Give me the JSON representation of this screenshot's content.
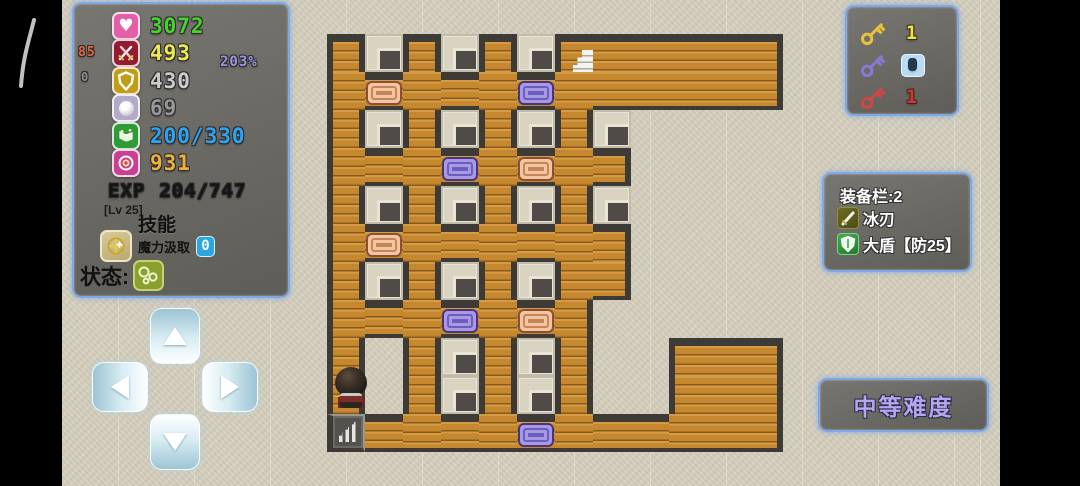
{
  "hud": {
    "stats": [
      {
        "name": "hp",
        "icon": "heart-icon",
        "value": "3072",
        "color": "#46d42a",
        "icon_bg": "#e35fa8"
      },
      {
        "name": "attack",
        "icon": "swords-icon",
        "value": "493",
        "color": "#efe94e",
        "icon_bg": "#941c30",
        "aux_left": "85",
        "aux_left_color": "#e2653a",
        "aux_right": "203%",
        "aux_right_color": "#9e95e8"
      },
      {
        "name": "defense",
        "icon": "shield-icon",
        "value": "430",
        "color": "#cccccc",
        "icon_bg": "#c39c16",
        "aux_left": "0",
        "aux_left_color": "#8f8f8f"
      },
      {
        "name": "gem",
        "icon": "orb-icon",
        "value": "69",
        "color": "#999999",
        "icon_bg": "#b2aac6"
      },
      {
        "name": "mana",
        "icon": "book-icon",
        "value": "200/330",
        "color": "#2fa3f0",
        "icon_bg": "#2e9a38"
      },
      {
        "name": "gold",
        "icon": "coin-icon",
        "value": "931",
        "color": "#eeb23a",
        "icon_bg": "#cb3e90"
      }
    ],
    "exp_label": "EXP",
    "exp_value": "204/747",
    "level_badge": "[Lv 25]",
    "skills_title": "技能",
    "skill": {
      "label": "魔力汲取",
      "count": "0"
    },
    "status_label": "状态:"
  },
  "keys": [
    {
      "name": "yellow-key",
      "count": "1",
      "key_color": "#e7c33c",
      "count_color": "#f2e42c"
    },
    {
      "name": "blue-key",
      "count": "0",
      "key_color": "#8a79d2",
      "count_color": "#1c3f6e"
    },
    {
      "name": "red-key",
      "count": "1",
      "key_color": "#d34545",
      "count_color": "#e03224"
    }
  ],
  "equipment": {
    "title": "装备栏:2",
    "items": [
      {
        "icon": "ice-blade-icon",
        "label": "冰刃"
      },
      {
        "icon": "big-shield-icon",
        "label": "大盾【防25】"
      }
    ]
  },
  "difficulty": {
    "label": "中等难度"
  },
  "map": {
    "tile": 38,
    "origin_x": 327,
    "origin_y": 34,
    "cols": 12,
    "door_colors": {
      "orange": "#f3c6a1",
      "purple": "#a89ae2"
    },
    "legend": {
      ".": "wood-floor",
      "#": "wall",
      "w": "wall-pillar",
      "O": "orange-door",
      "P": "purple-door",
      "S": "stairs-up",
      "D": "stairs-down",
      "@": "player"
    },
    "rows": [
      ".w.w.wS.....",
      ".O...P......",
      ".w.w.w.w####",
      "...P.O..####",
      ".w.w.w.w####",
      ".O......####",
      ".w.w.w..####",
      "...P.O.#####",
      ".#.w.w.##...",
      "@#.w.w.##...",
      "D....P......"
    ]
  }
}
